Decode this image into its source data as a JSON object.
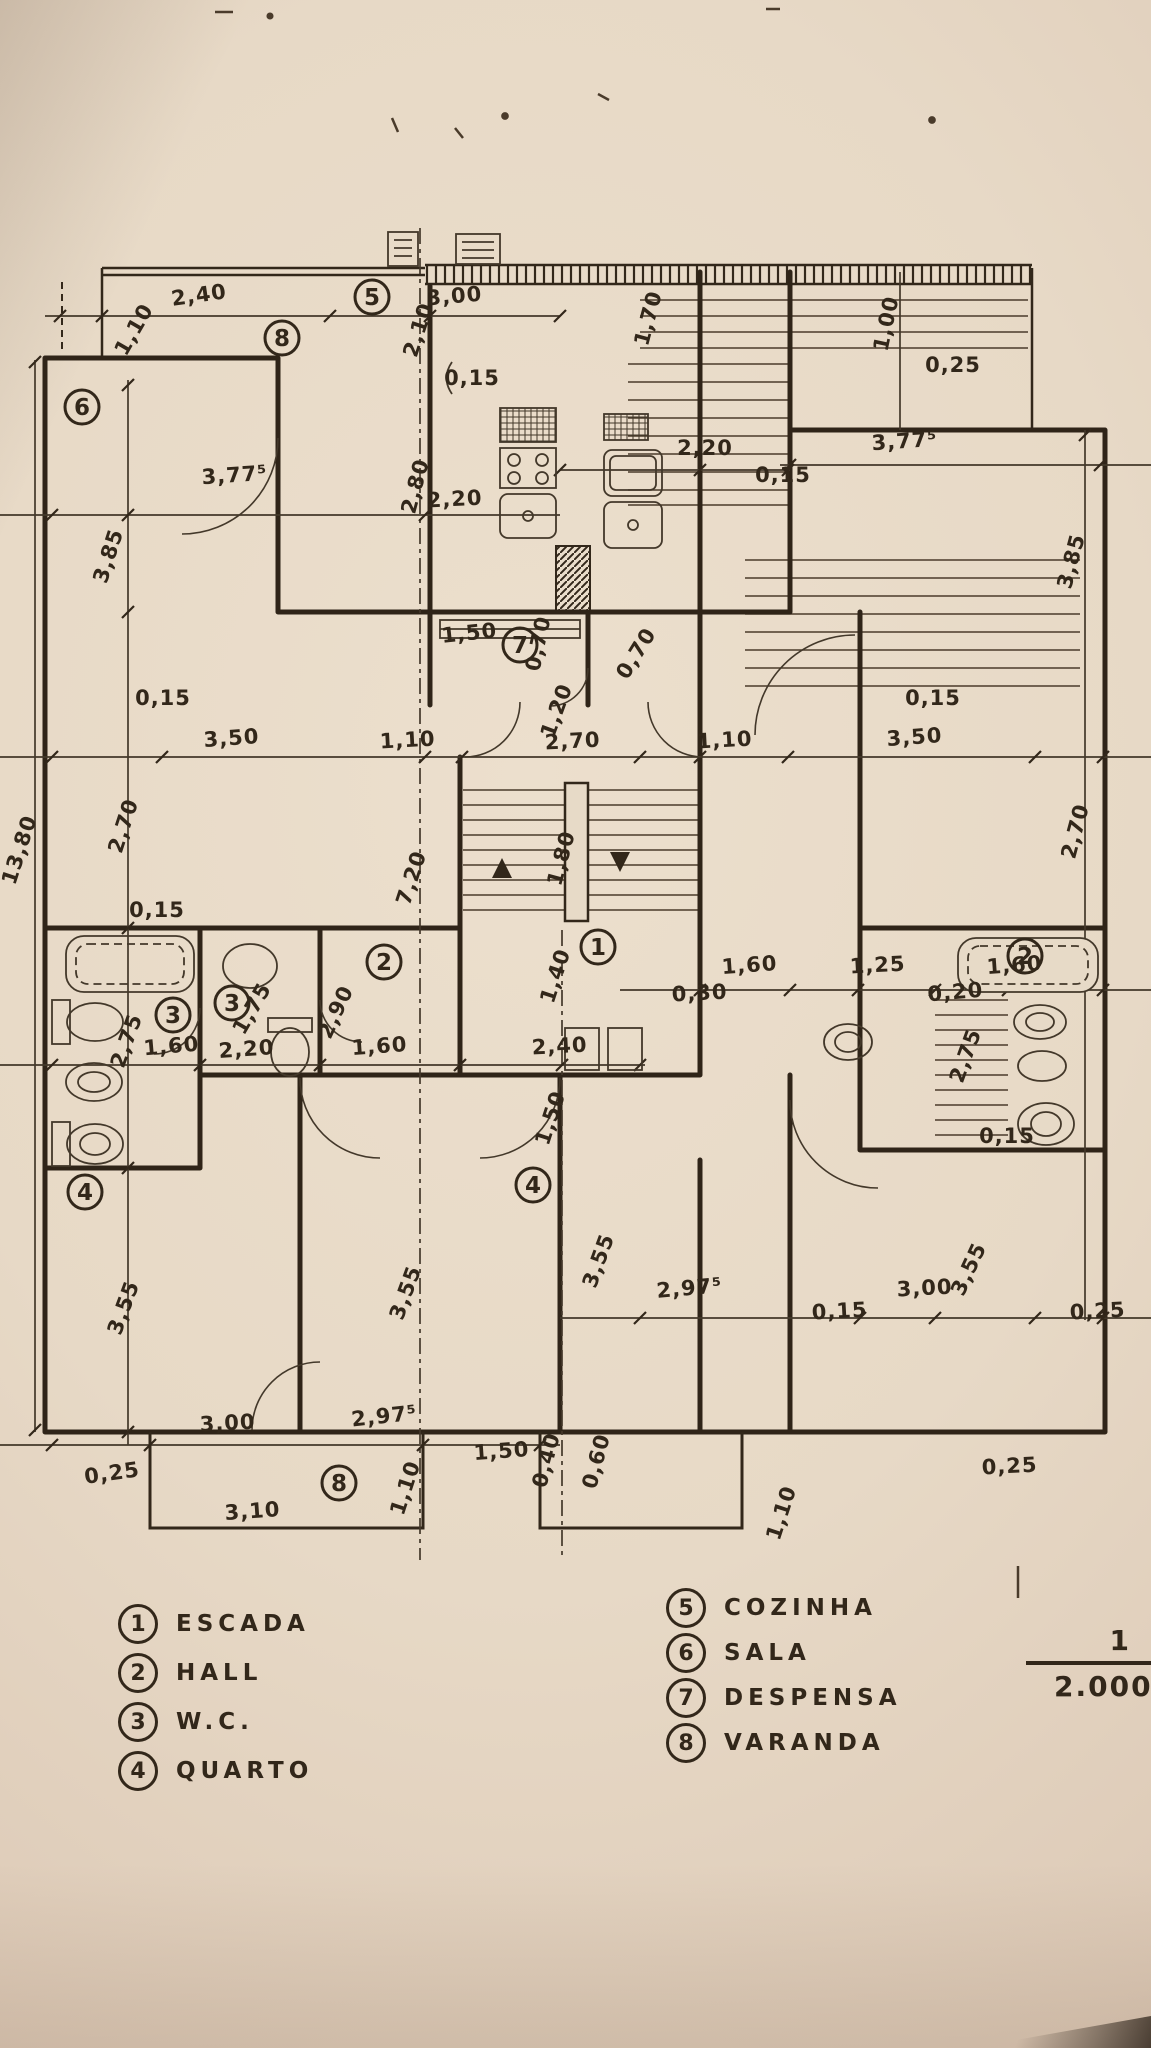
{
  "palette": {
    "paper": "#e7dac7",
    "ink": "#32271a",
    "thin_line": "#43382a"
  },
  "legend": {
    "items": [
      {
        "n": "1",
        "label": "ESCADA"
      },
      {
        "n": "2",
        "label": "HALL"
      },
      {
        "n": "3",
        "label": "W.C."
      },
      {
        "n": "4",
        "label": "QUARTO"
      },
      {
        "n": "5",
        "label": "COZINHA"
      },
      {
        "n": "6",
        "label": "SALA"
      },
      {
        "n": "7",
        "label": "DESPENSA"
      },
      {
        "n": "8",
        "label": "VARANDA"
      }
    ]
  },
  "scale": {
    "numerator": "1",
    "denominator": "2.000"
  },
  "plan": {
    "overall_height": "13,80",
    "labels": [
      {
        "t": "2,40",
        "x": 200,
        "y": 302,
        "r": -8
      },
      {
        "t": "1,10",
        "x": 140,
        "y": 333,
        "r": -60
      },
      {
        "t": "3,00",
        "x": 455,
        "y": 303,
        "r": -5
      },
      {
        "t": "2,10",
        "x": 425,
        "y": 332,
        "r": -72
      },
      {
        "t": "0,15",
        "x": 472,
        "y": 385,
        "r": 0
      },
      {
        "t": "1,70",
        "x": 655,
        "y": 320,
        "r": -75
      },
      {
        "t": "1,00",
        "x": 893,
        "y": 325,
        "r": -78
      },
      {
        "t": "0,25",
        "x": 953,
        "y": 372,
        "r": 0
      },
      {
        "t": "2,20",
        "x": 705,
        "y": 455,
        "r": 0
      },
      {
        "t": "3,77⁵",
        "x": 905,
        "y": 448,
        "r": -4
      },
      {
        "t": "0,15",
        "x": 783,
        "y": 482,
        "r": 0
      },
      {
        "t": "2,80",
        "x": 422,
        "y": 488,
        "r": -75
      },
      {
        "t": "2,20",
        "x": 455,
        "y": 506,
        "r": -3
      },
      {
        "t": "3,77⁵",
        "x": 235,
        "y": 482,
        "r": -4
      },
      {
        "t": "3,85",
        "x": 115,
        "y": 558,
        "r": -72
      },
      {
        "t": "3,85",
        "x": 1078,
        "y": 563,
        "r": -75
      },
      {
        "t": "1,50",
        "x": 470,
        "y": 640,
        "r": -6
      },
      {
        "t": "0,70",
        "x": 545,
        "y": 645,
        "r": -78
      },
      {
        "t": "0,70",
        "x": 642,
        "y": 657,
        "r": -58
      },
      {
        "t": "1,20",
        "x": 563,
        "y": 713,
        "r": -70
      },
      {
        "t": "0,15",
        "x": 163,
        "y": 705,
        "r": 0
      },
      {
        "t": "3,50",
        "x": 232,
        "y": 745,
        "r": -4
      },
      {
        "t": "1,10",
        "x": 408,
        "y": 747,
        "r": -3
      },
      {
        "t": "2,70",
        "x": 573,
        "y": 748,
        "r": -3
      },
      {
        "t": "1,10",
        "x": 725,
        "y": 747,
        "r": -3
      },
      {
        "t": "3,50",
        "x": 915,
        "y": 744,
        "r": -4
      },
      {
        "t": "0,15",
        "x": 933,
        "y": 705,
        "r": 0
      },
      {
        "t": "2,70",
        "x": 130,
        "y": 828,
        "r": -72
      },
      {
        "t": "2,70",
        "x": 1082,
        "y": 833,
        "r": -75
      },
      {
        "t": "7,20",
        "x": 418,
        "y": 880,
        "r": -72
      },
      {
        "t": "1,80",
        "x": 568,
        "y": 860,
        "r": -75
      },
      {
        "t": "1,40",
        "x": 562,
        "y": 978,
        "r": -72
      },
      {
        "t": "2,90",
        "x": 342,
        "y": 1015,
        "r": -65
      },
      {
        "t": "0,15",
        "x": 157,
        "y": 917,
        "r": 0
      },
      {
        "t": "2,75",
        "x": 133,
        "y": 1043,
        "r": -70
      },
      {
        "t": "1,75",
        "x": 258,
        "y": 1012,
        "r": -60
      },
      {
        "t": "1,60",
        "x": 172,
        "y": 1053,
        "r": -5
      },
      {
        "t": "2,20",
        "x": 247,
        "y": 1056,
        "r": -4
      },
      {
        "t": "1,60",
        "x": 380,
        "y": 1053,
        "r": -4
      },
      {
        "t": "2,40",
        "x": 560,
        "y": 1053,
        "r": -3
      },
      {
        "t": "1,50",
        "x": 557,
        "y": 1120,
        "r": -72
      },
      {
        "t": "1,60",
        "x": 750,
        "y": 972,
        "r": -4
      },
      {
        "t": "0,30",
        "x": 700,
        "y": 1000,
        "r": -3
      },
      {
        "t": "1,25",
        "x": 878,
        "y": 972,
        "r": -3
      },
      {
        "t": "1,60",
        "x": 1015,
        "y": 972,
        "r": -4
      },
      {
        "t": "0,20",
        "x": 956,
        "y": 999,
        "r": -5
      },
      {
        "t": "2,75",
        "x": 972,
        "y": 1058,
        "r": -70
      },
      {
        "t": "0,15",
        "x": 1007,
        "y": 1143,
        "r": 0
      },
      {
        "t": "3,55",
        "x": 130,
        "y": 1310,
        "r": -70
      },
      {
        "t": "3,55",
        "x": 412,
        "y": 1295,
        "r": -70
      },
      {
        "t": "3,55",
        "x": 605,
        "y": 1263,
        "r": -70
      },
      {
        "t": "3,55",
        "x": 975,
        "y": 1272,
        "r": -65
      },
      {
        "t": "2,97⁵",
        "x": 690,
        "y": 1295,
        "r": -5
      },
      {
        "t": "3,00",
        "x": 925,
        "y": 1295,
        "r": -3
      },
      {
        "t": "0,15",
        "x": 840,
        "y": 1318,
        "r": -3
      },
      {
        "t": "0,25",
        "x": 1098,
        "y": 1318,
        "r": -3
      },
      {
        "t": "3,00",
        "x": 228,
        "y": 1430,
        "r": -3
      },
      {
        "t": "2,97⁵",
        "x": 385,
        "y": 1423,
        "r": -6
      },
      {
        "t": "0,25",
        "x": 113,
        "y": 1480,
        "r": -8
      },
      {
        "t": "3,10",
        "x": 253,
        "y": 1518,
        "r": -4
      },
      {
        "t": "1,10",
        "x": 412,
        "y": 1490,
        "r": -72
      },
      {
        "t": "1,50",
        "x": 502,
        "y": 1458,
        "r": -4
      },
      {
        "t": "0,40",
        "x": 553,
        "y": 1462,
        "r": -75
      },
      {
        "t": "0,60",
        "x": 603,
        "y": 1463,
        "r": -75
      },
      {
        "t": "1,10",
        "x": 788,
        "y": 1515,
        "r": -72
      },
      {
        "t": "0,25",
        "x": 1010,
        "y": 1473,
        "r": -3
      },
      {
        "t": "13,80",
        "x": 26,
        "y": 852,
        "r": -72
      }
    ],
    "room_markers": [
      {
        "n": "6",
        "x": 82,
        "y": 407
      },
      {
        "n": "8",
        "x": 282,
        "y": 338
      },
      {
        "n": "5",
        "x": 372,
        "y": 297
      },
      {
        "n": "7",
        "x": 520,
        "y": 645
      },
      {
        "n": "1",
        "x": 598,
        "y": 947
      },
      {
        "n": "2",
        "x": 384,
        "y": 962
      },
      {
        "n": "2",
        "x": 1025,
        "y": 956
      },
      {
        "n": "3",
        "x": 173,
        "y": 1015
      },
      {
        "n": "3",
        "x": 232,
        "y": 1003
      },
      {
        "n": "4",
        "x": 85,
        "y": 1192
      },
      {
        "n": "4",
        "x": 533,
        "y": 1185
      },
      {
        "n": "8",
        "x": 339,
        "y": 1483
      }
    ]
  }
}
